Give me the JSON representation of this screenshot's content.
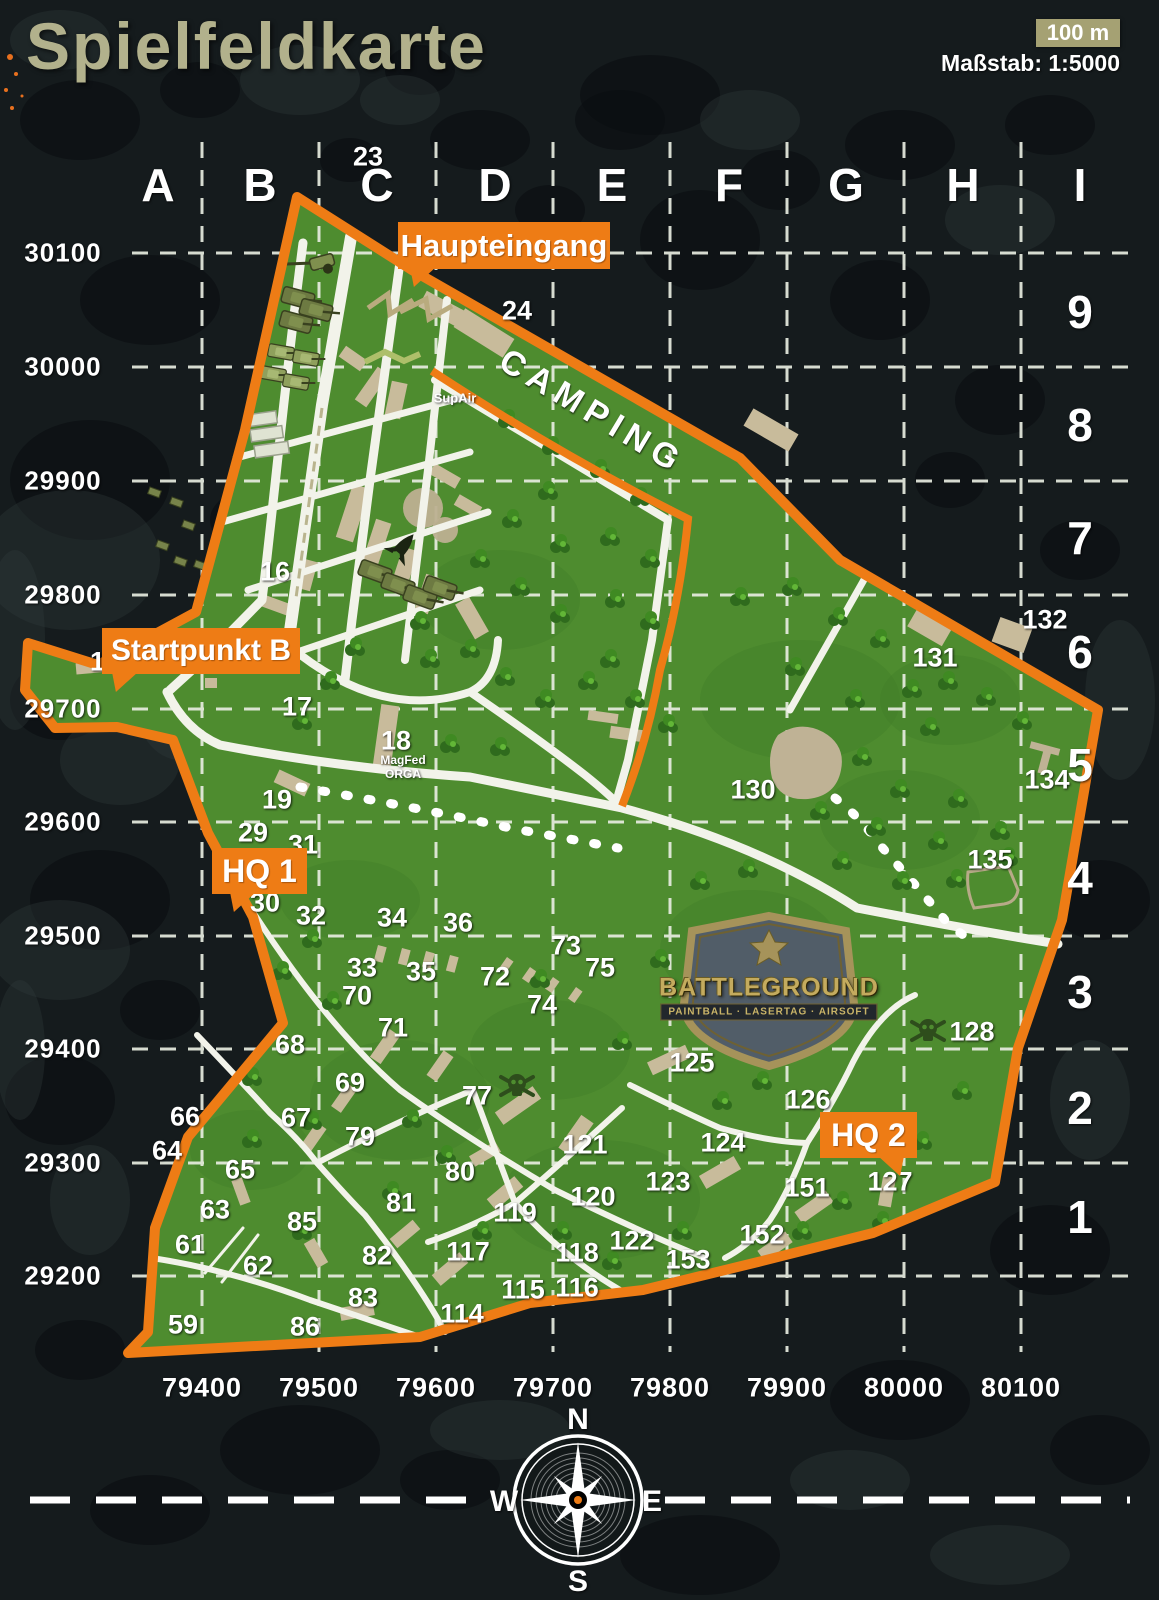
{
  "title": "Spielfeldkarte",
  "scale": {
    "bar_label": "100 m",
    "text": "Maßstab: 1:5000"
  },
  "grid": {
    "columns": [
      "A",
      "B",
      "C",
      "D",
      "E",
      "F",
      "G",
      "H",
      "I"
    ],
    "rows": [
      "9",
      "8",
      "7",
      "6",
      "5",
      "4",
      "3",
      "2",
      "1"
    ],
    "northings": [
      "30100",
      "30000",
      "29900",
      "29800",
      "29700",
      "29600",
      "29500",
      "29400",
      "29300",
      "29200"
    ],
    "eastings": [
      "79400",
      "79500",
      "79600",
      "79700",
      "79800",
      "79900",
      "80000",
      "80100"
    ]
  },
  "callouts": [
    {
      "id": "haupteingang",
      "label": "Haupteingang"
    },
    {
      "id": "startpunkt-b",
      "label": "Startpunkt B"
    },
    {
      "id": "hq1",
      "label": "HQ 1"
    },
    {
      "id": "hq2",
      "label": "HQ 2"
    }
  ],
  "areas": {
    "camping": "CAMPING",
    "supair": "SupAir",
    "magfed_line1": "MagFed",
    "magfed_line2": "ORGA"
  },
  "logo": {
    "name": "BATTLEGROUND",
    "subtitle": "PAINTBALL · LASERTAG · AIRSOFT"
  },
  "compass": {
    "n": "N",
    "s": "S",
    "e": "E",
    "w": "W"
  },
  "poi_numbers": [
    {
      "n": "14",
      "x": 105,
      "y": 662
    },
    {
      "n": "16",
      "x": 275,
      "y": 572
    },
    {
      "n": "17",
      "x": 297,
      "y": 707
    },
    {
      "n": "18",
      "x": 396,
      "y": 741
    },
    {
      "n": "19",
      "x": 277,
      "y": 800
    },
    {
      "n": "23",
      "x": 368,
      "y": 157
    },
    {
      "n": "24",
      "x": 517,
      "y": 311
    },
    {
      "n": "29",
      "x": 253,
      "y": 833
    },
    {
      "n": "30",
      "x": 265,
      "y": 903
    },
    {
      "n": "31",
      "x": 303,
      "y": 845
    },
    {
      "n": "32",
      "x": 311,
      "y": 916
    },
    {
      "n": "33",
      "x": 362,
      "y": 968
    },
    {
      "n": "34",
      "x": 392,
      "y": 918
    },
    {
      "n": "35",
      "x": 421,
      "y": 972
    },
    {
      "n": "36",
      "x": 458,
      "y": 923
    },
    {
      "n": "59",
      "x": 183,
      "y": 1325
    },
    {
      "n": "61",
      "x": 190,
      "y": 1245
    },
    {
      "n": "62",
      "x": 258,
      "y": 1266
    },
    {
      "n": "63",
      "x": 215,
      "y": 1210
    },
    {
      "n": "64",
      "x": 167,
      "y": 1151
    },
    {
      "n": "65",
      "x": 240,
      "y": 1170
    },
    {
      "n": "66",
      "x": 185,
      "y": 1117
    },
    {
      "n": "67",
      "x": 296,
      "y": 1118
    },
    {
      "n": "68",
      "x": 290,
      "y": 1045
    },
    {
      "n": "69",
      "x": 350,
      "y": 1083
    },
    {
      "n": "70",
      "x": 357,
      "y": 996
    },
    {
      "n": "71",
      "x": 393,
      "y": 1028
    },
    {
      "n": "72",
      "x": 495,
      "y": 977
    },
    {
      "n": "73",
      "x": 566,
      "y": 946
    },
    {
      "n": "74",
      "x": 542,
      "y": 1005
    },
    {
      "n": "75",
      "x": 600,
      "y": 968
    },
    {
      "n": "77",
      "x": 477,
      "y": 1096
    },
    {
      "n": "79",
      "x": 360,
      "y": 1137
    },
    {
      "n": "80",
      "x": 460,
      "y": 1172
    },
    {
      "n": "81",
      "x": 401,
      "y": 1203
    },
    {
      "n": "82",
      "x": 377,
      "y": 1256
    },
    {
      "n": "83",
      "x": 363,
      "y": 1298
    },
    {
      "n": "85",
      "x": 302,
      "y": 1222
    },
    {
      "n": "86",
      "x": 305,
      "y": 1327
    },
    {
      "n": "114",
      "x": 462,
      "y": 1314
    },
    {
      "n": "115",
      "x": 523,
      "y": 1290
    },
    {
      "n": "116",
      "x": 577,
      "y": 1288
    },
    {
      "n": "117",
      "x": 468,
      "y": 1252
    },
    {
      "n": "118",
      "x": 577,
      "y": 1253
    },
    {
      "n": "119",
      "x": 515,
      "y": 1213
    },
    {
      "n": "120",
      "x": 593,
      "y": 1197
    },
    {
      "n": "121",
      "x": 585,
      "y": 1145
    },
    {
      "n": "122",
      "x": 632,
      "y": 1241
    },
    {
      "n": "123",
      "x": 668,
      "y": 1182
    },
    {
      "n": "124",
      "x": 723,
      "y": 1143
    },
    {
      "n": "125",
      "x": 692,
      "y": 1063
    },
    {
      "n": "126",
      "x": 808,
      "y": 1100
    },
    {
      "n": "127",
      "x": 890,
      "y": 1182
    },
    {
      "n": "128",
      "x": 972,
      "y": 1032
    },
    {
      "n": "130",
      "x": 753,
      "y": 790
    },
    {
      "n": "131",
      "x": 935,
      "y": 658
    },
    {
      "n": "132",
      "x": 1045,
      "y": 620
    },
    {
      "n": "134",
      "x": 1047,
      "y": 780
    },
    {
      "n": "135",
      "x": 990,
      "y": 860
    },
    {
      "n": "151",
      "x": 807,
      "y": 1188
    },
    {
      "n": "152",
      "x": 762,
      "y": 1235
    },
    {
      "n": "153",
      "x": 688,
      "y": 1260
    }
  ],
  "colors": {
    "orange": "#ee7c15",
    "field_green": "#4e8c2f",
    "tan": "#c8bb9b",
    "title_olive": "#b2b18c",
    "scale_olive": "#a5a173",
    "road_white": "#f2f3ea"
  }
}
